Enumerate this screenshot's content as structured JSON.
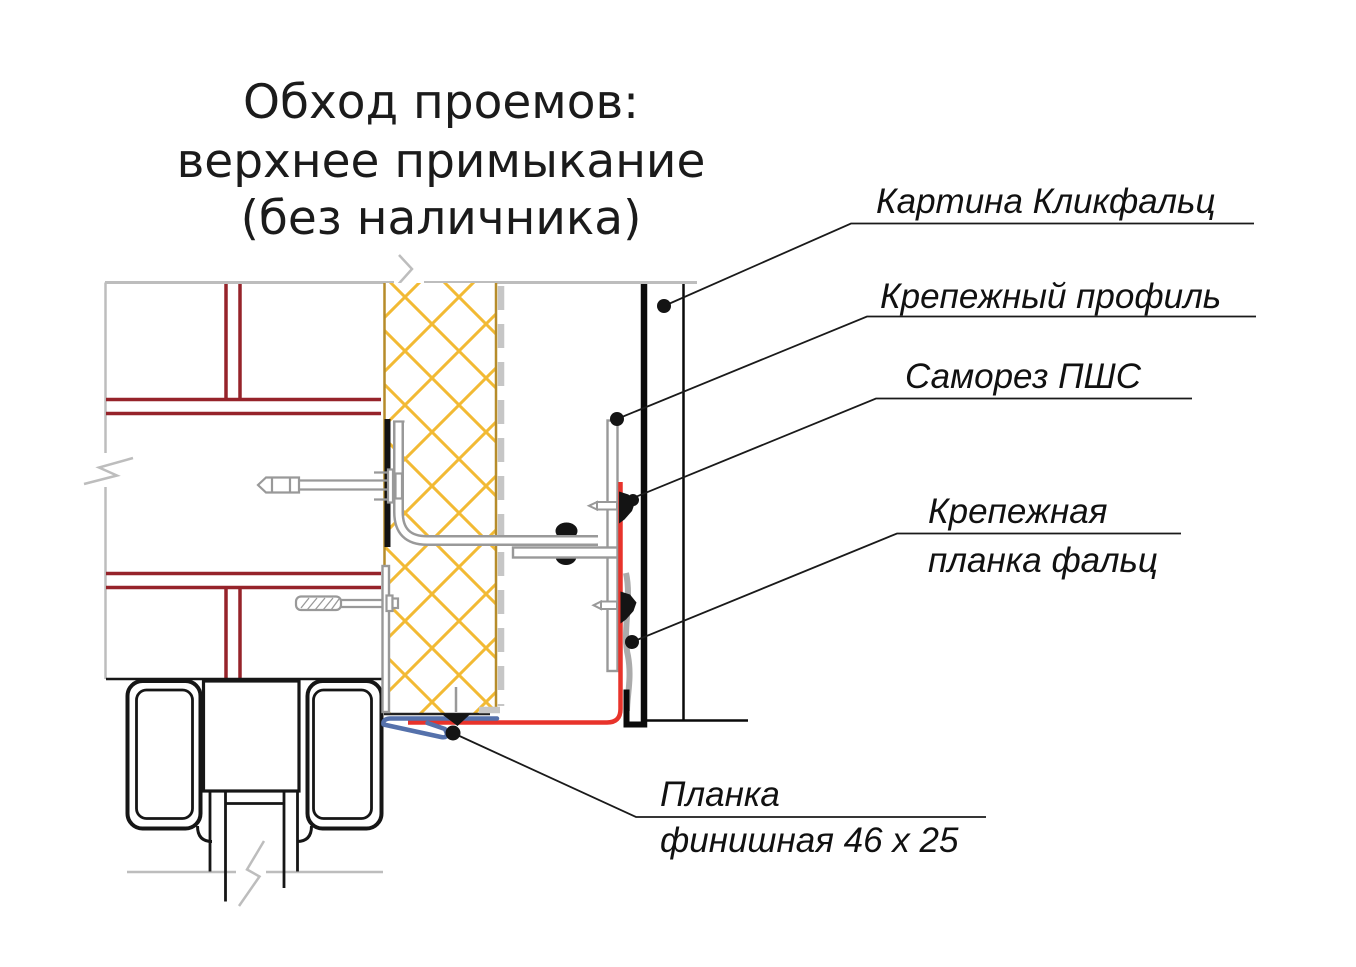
{
  "diagram": {
    "title": {
      "line1": "Обход проемов:",
      "line2": "верхнее примыкание",
      "line3": "(без наличника)"
    },
    "callouts": {
      "panel": "Картина Кликфальц",
      "profile": "Крепежный профиль",
      "screw": "Саморез ПШС",
      "clamp_line1": "Крепежная",
      "clamp_line2": "планка фальц",
      "finish_line1": "Планка",
      "finish_line2": "финишная 46 x 25"
    },
    "colors": {
      "brick_joint": "#96232a",
      "insulation_hatch": "#f2ba34",
      "insulation_edge": "#b68c2a",
      "clamp_strip_red": "#e8332b",
      "finish_strip_blue": "#5571ab",
      "wall_outline": "#bdbdbd",
      "metal_gray": "#999999",
      "metal_light": "#ababab",
      "panel_black": "#0a0a0a",
      "frame_black": "#161616"
    }
  }
}
